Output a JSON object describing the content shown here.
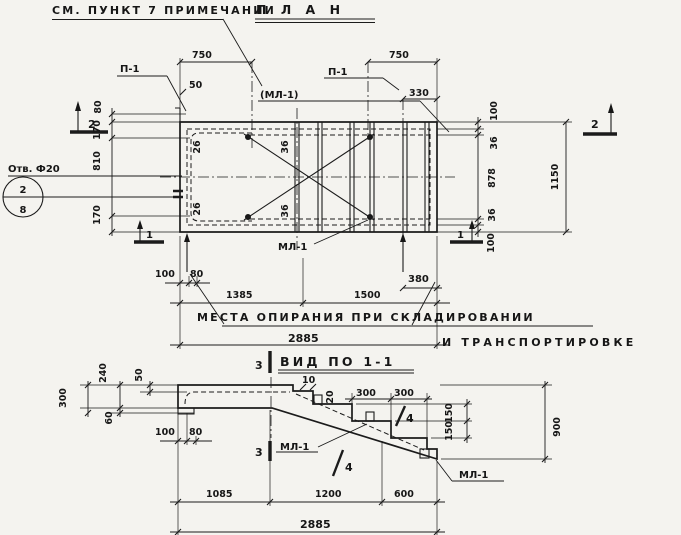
{
  "plan": {
    "note": "СМ. ПУНКТ 7 ПРИМЕЧАНИИ",
    "title": "П Л А Н",
    "label_p1_left": "П-1",
    "label_p1_right": "П-1",
    "label_ml1_bracket": "(МЛ-1)",
    "label_ml1_bottom": "МЛ-1",
    "label_otv": "Отв. Ф20",
    "balloon_top": "2",
    "balloon_bottom": "8",
    "pos_26_top": "26",
    "pos_26_bottom": "26",
    "pos_36_top": "36",
    "pos_36_bottom": "36",
    "section_2": "2",
    "section_1": "1",
    "dim_750_left": "750",
    "dim_50": "50",
    "dim_750_right": "750",
    "dim_330": "330",
    "dim_100_top_right": "100",
    "dim_36_top_right": "36",
    "dim_878": "878",
    "dim_36_bottom_right": "36",
    "dim_100_bottom_right": "100",
    "dim_1150": "1150",
    "dim_80_left": "80",
    "dim_170_top": "170",
    "dim_810": "810",
    "dim_170_bottom": "170",
    "dim_100_bottom_left": "100",
    "dim_80_bottom_left": "80",
    "dim_1385": "1385",
    "dim_1500": "1500",
    "dim_380": "380",
    "dim_2885": "2885",
    "support_note_line1": "МЕСТА ОПИРАНИЯ ПРИ СКЛАДИРОВАНИИ",
    "support_note_line2": "И ТРАНСПОРТИРОВКЕ"
  },
  "view": {
    "title": "ВИД ПО 1-1",
    "section_3": "3",
    "label_ml1_mid": "МЛ-1",
    "label_ml1_end": "МЛ-1",
    "pos_4_upper": "4",
    "pos_4_lower": "4",
    "dim_300_left": "300",
    "dim_240": "240",
    "dim_50": "50",
    "dim_60": "60",
    "dim_100": "100",
    "dim_80": "80",
    "dim_10": "10",
    "dim_20": "20",
    "dim_300_a": "300",
    "dim_300_b": "300",
    "dim_150_a": "150",
    "dim_150_b": "150",
    "dim_900": "900",
    "dim_1085": "1085",
    "dim_1200": "1200",
    "dim_600": "600",
    "dim_2885": "2885"
  }
}
